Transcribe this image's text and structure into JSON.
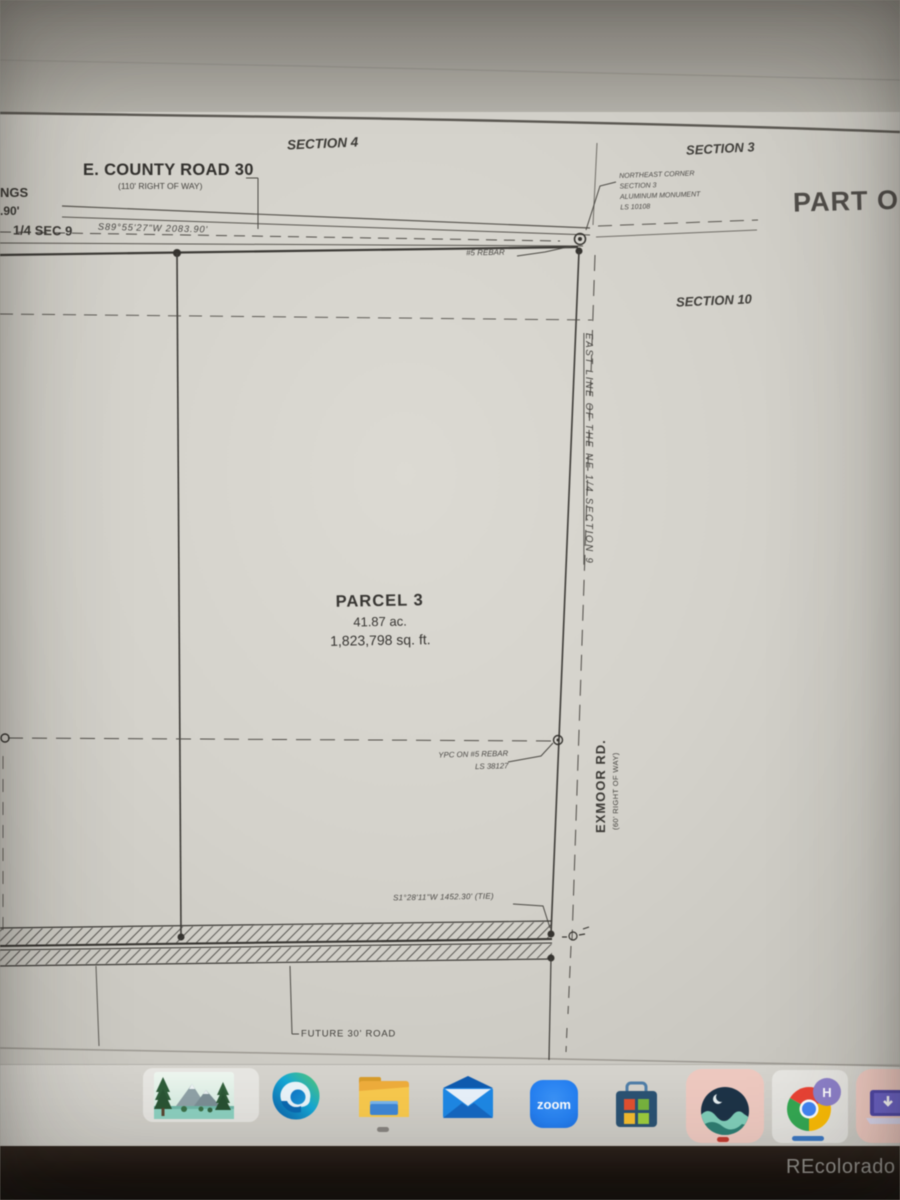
{
  "watermark": "REcolorado",
  "plat": {
    "section_labels": {
      "s4": "SECTION 4",
      "s3": "SECTION 3",
      "s10": "SECTION 10"
    },
    "part_of": "PART OF",
    "county_road": {
      "name": "E. COUNTY ROAD 30",
      "right_of_way": "(110' RIGHT OF WAY)"
    },
    "bearing_top": "S89°55'27\"W  2083.90'",
    "left_edge_text": {
      "l1": "NGS",
      "l2": ".90'",
      "l3": "1/4 SEC 9"
    },
    "ne_corner_note": {
      "l1": "NORTHEAST CORNER",
      "l2": "SECTION 3",
      "l3": "ALUMINUM MONUMENT",
      "l4": "LS 10108"
    },
    "rebar_label": "#5 REBAR",
    "east_line_label": "EAST LINE OF THE NE 1/4 SECTION 9",
    "parcel": {
      "name": "PARCEL 3",
      "area_acres": "41.87 ac.",
      "area_sqft": "1,823,798 sq. ft."
    },
    "ypc_note": {
      "l1": "YPC ON #5 REBAR",
      "l2": "LS 38127"
    },
    "exmoor": {
      "name": "EXMOOR RD.",
      "right_of_way": "(60' RIGHT OF WAY)"
    },
    "tie_label": "S1°28'11\"W  1452.30' (TIE)",
    "future_road_label": "FUTURE 30' ROAD"
  },
  "taskbar": {
    "zoom_label": "zoom",
    "chrome_badge": "H",
    "items": [
      {
        "name": "nature-photo"
      },
      {
        "name": "microsoft-edge"
      },
      {
        "name": "file-explorer"
      },
      {
        "name": "mail"
      },
      {
        "name": "zoom"
      },
      {
        "name": "microsoft-store"
      },
      {
        "name": "wave-app"
      },
      {
        "name": "google-chrome"
      },
      {
        "name": "download-app"
      }
    ]
  },
  "colors": {
    "zoom_blue": "#2681f2",
    "indicator_red": "#bf3a30",
    "indicator_blue": "#3b77c2",
    "pink_tile": "#eec9c0",
    "chrome_badge_purple": "#8d80c9"
  }
}
